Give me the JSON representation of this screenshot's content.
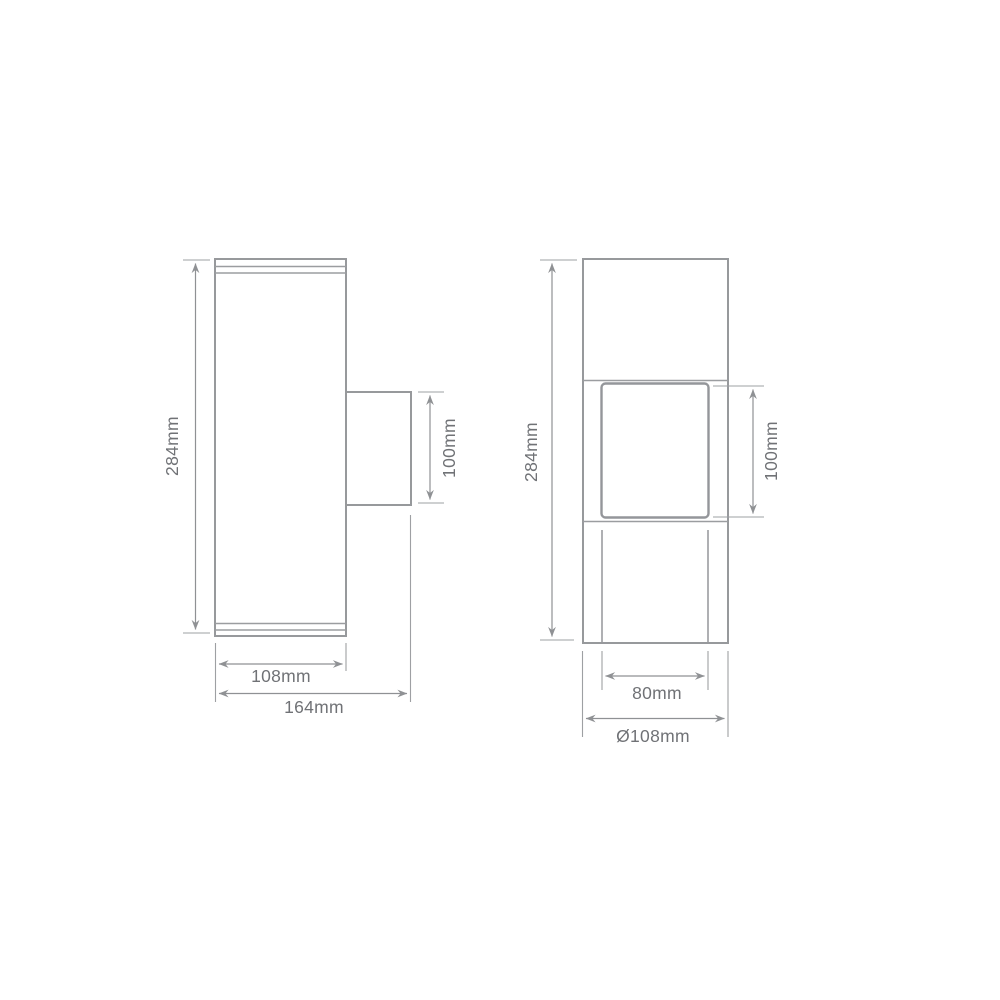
{
  "page": {
    "background_color": "#ffffff"
  },
  "drawing": {
    "description": "Technical dimension line drawing of an up/down wall light fixture, two orthographic views",
    "colors": {
      "outline": "#97999c",
      "dimension_line": "#8f9194",
      "label_text": "#707276"
    },
    "side_view": {
      "name": "side view",
      "dims": {
        "overall_height": "284mm",
        "bracket_height": "100mm",
        "body_width": "108mm",
        "overall_depth": "164mm"
      }
    },
    "front_view": {
      "name": "front view",
      "dims": {
        "overall_height": "284mm",
        "window_height": "100mm",
        "window_width": "80mm",
        "body_diameter": "Ø108mm"
      }
    }
  }
}
